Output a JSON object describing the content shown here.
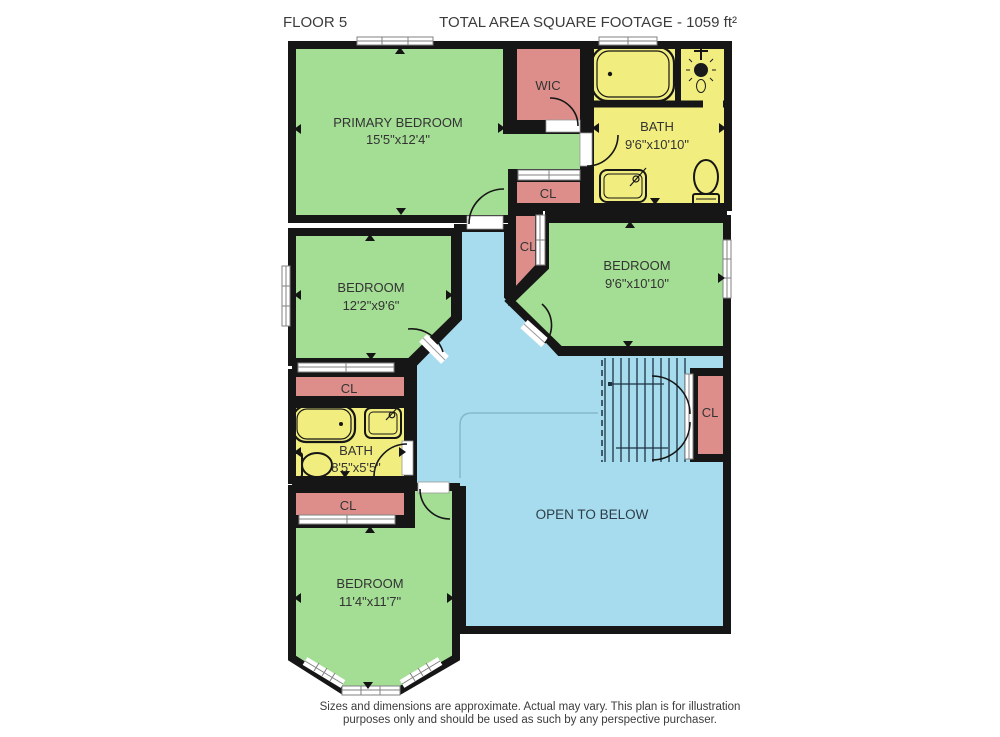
{
  "header": {
    "floor_label": "FLOOR 5",
    "area_label": "TOTAL AREA SQUARE FOOTAGE - 1059 ft²"
  },
  "rooms": {
    "primary_bedroom": {
      "name": "PRIMARY BEDROOM",
      "dims": "15'5\"x12'4\""
    },
    "wic": {
      "name": "WIC"
    },
    "bath_upper": {
      "name": "BATH",
      "dims": "9'6\"x10'10\""
    },
    "bedroom_right": {
      "name": "BEDROOM",
      "dims": "9'6\"x10'10\""
    },
    "bedroom_mid": {
      "name": "BEDROOM",
      "dims": "12'2\"x9'6\""
    },
    "bath_lower": {
      "name": "BATH",
      "dims": "8'5\"x5'5\""
    },
    "bedroom_bottom": {
      "name": "BEDROOM",
      "dims": "11'4\"x11'7\""
    },
    "open_below": {
      "name": "OPEN TO BELOW"
    }
  },
  "closets": {
    "cl1": "CL",
    "cl2": "CL",
    "cl3": "CL",
    "cl4": "CL",
    "cl5": "CL"
  },
  "footer": {
    "line1": "Sizes and dimensions are approximate. Actual may vary. This plan is for illustration",
    "line2": "purposes only and should be used as such by any perspective purchaser."
  },
  "colors": {
    "bedroom_green": "#a3de94",
    "bath_yellow": "#f1ee7f",
    "closet_pink": "#dd8e8a",
    "hall_blue": "#a6dcee",
    "wall_black": "#161616"
  }
}
